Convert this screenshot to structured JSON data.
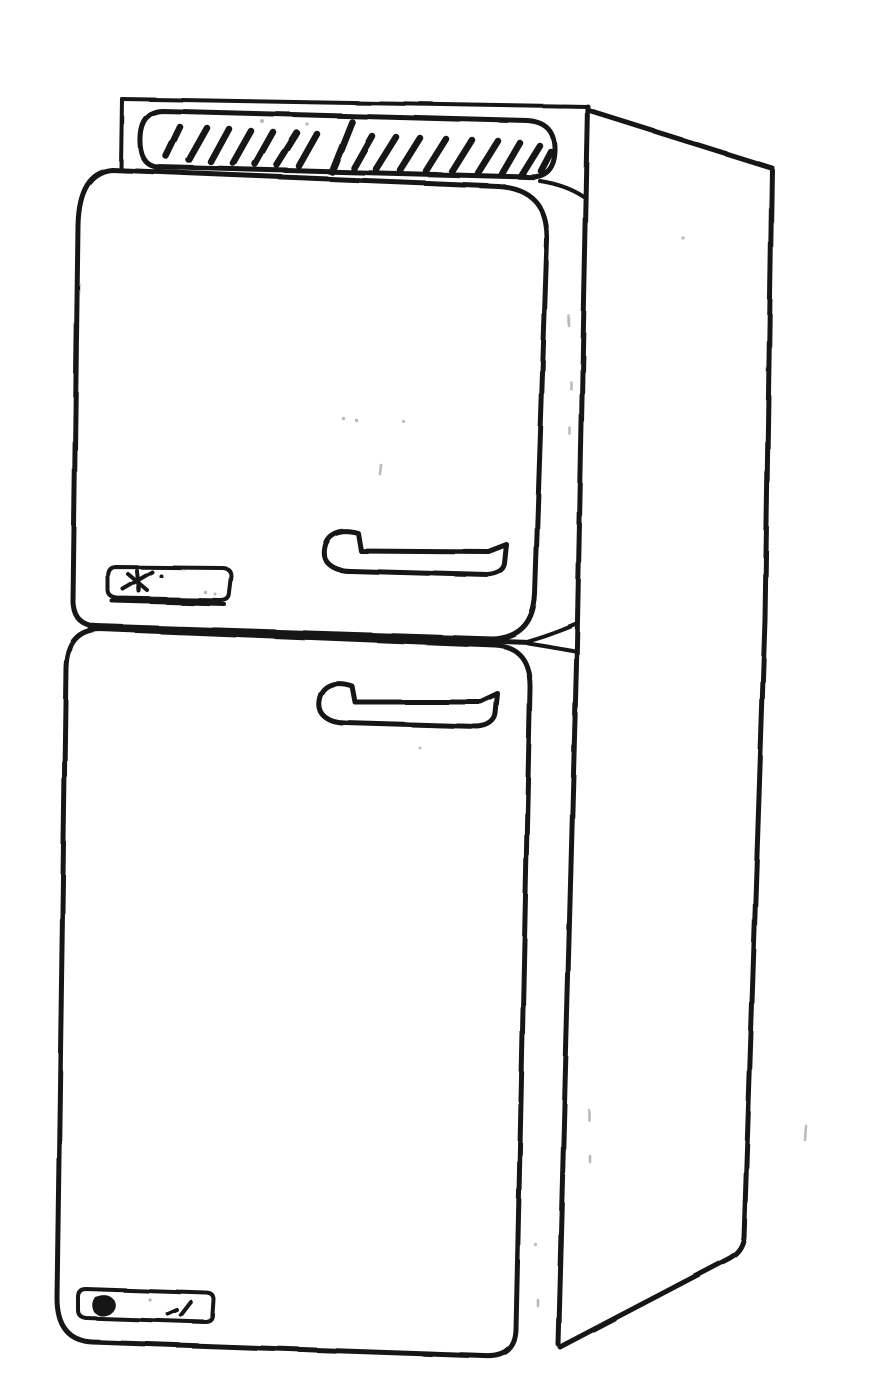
{
  "canvas": {
    "width_px": 892,
    "height_px": 1387
  },
  "colors": {
    "ink": "#161616",
    "paper": "#ffffff",
    "speck": "#8a8a8a"
  },
  "scene": {
    "description": "Monochrome ink line drawing of a two-door top-freezer refrigerator in three-quarter perspective: hatched top panel, horizontal bar handle on each door, a small scribbled nameplate on the upper freezer door and another near the bottom of the lower door, with the cabinet right side panel receding to the right",
    "object": "refrigerator",
    "view": "three-quarter front, right side visible",
    "style": "scanned hand-drawn line art, black ink on white paper",
    "parts": [
      {
        "id": "cabinet-back-frame",
        "label": "cabinet top back frame"
      },
      {
        "id": "cabinet-side-panel",
        "label": "cabinet right side panel"
      },
      {
        "id": "top-hatched-panel",
        "label": "hatched top surface panel"
      },
      {
        "id": "freezer-door",
        "label": "upper freezer door"
      },
      {
        "id": "fridge-door",
        "label": "lower refrigerator door"
      },
      {
        "id": "door-divider",
        "label": "gap line between the two doors"
      },
      {
        "id": "freezer-door-handle",
        "label": "freezer door bar handle"
      },
      {
        "id": "fridge-door-handle",
        "label": "refrigerator door bar handle"
      },
      {
        "id": "freezer-nameplate",
        "label": "nameplate badge with scribbled logo on freezer door"
      },
      {
        "id": "fridge-nameplate",
        "label": "nameplate badge with dark logo mark near bottom of lower door"
      },
      {
        "id": "scan-specks",
        "label": "stray scanner speckles"
      }
    ]
  }
}
